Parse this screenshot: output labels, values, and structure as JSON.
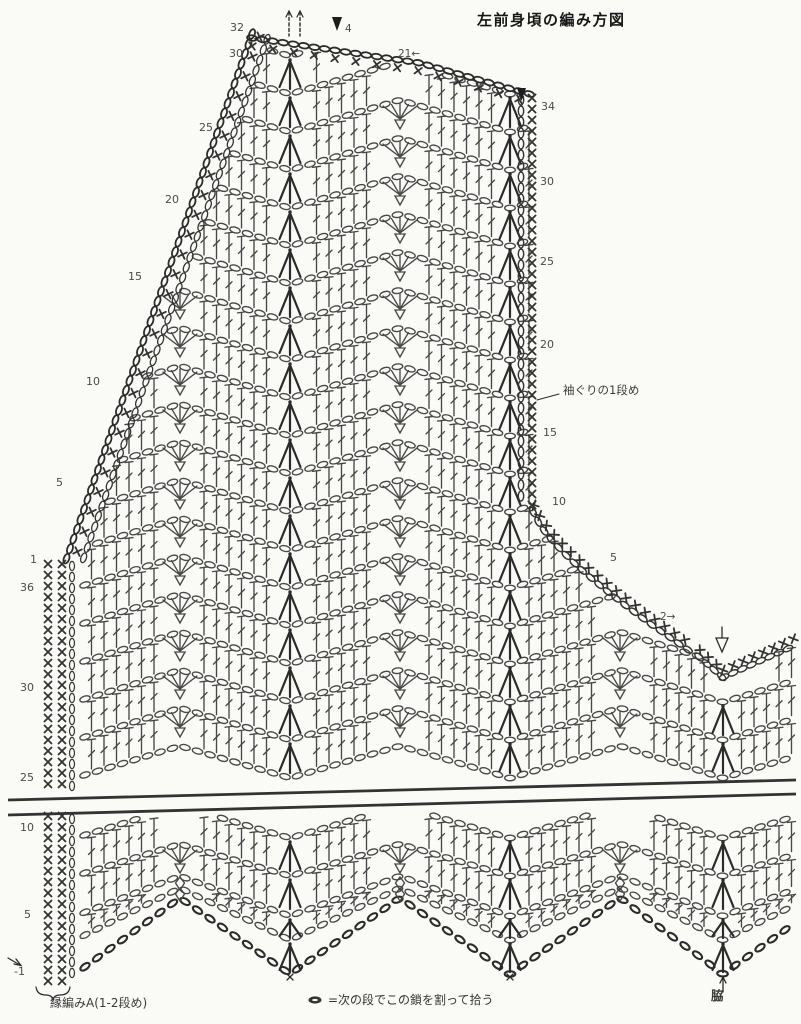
{
  "title": "左前身頃の編み方図",
  "colors": {
    "ink": "#474747",
    "ink_dark": "#2b2b2b",
    "edge": "#333333",
    "label": "#4a4a4a",
    "background": "#fafaf7"
  },
  "labels": {
    "armhole_row1": "袖ぐりの1段め",
    "edging_a": "縁編みA(1-2段め)",
    "side": "脇",
    "legend_text": "=次の段でこの鎖を割って拾う",
    "start_row_top": "4",
    "row_marker_21": "21←",
    "row_marker_2": "2→"
  },
  "stitch_symbols": [
    "chain-oval",
    "single-crochet-x",
    "double-crochet-bar",
    "cluster-3dc-decrease",
    "shell-5dc-increase",
    "picot-triangle",
    "start-arrow-filled",
    "start-arrow-open"
  ],
  "row_numbers": {
    "neck_edge": [
      {
        "v": "32",
        "x": 230,
        "y": 22
      },
      {
        "v": "30",
        "x": 229,
        "y": 48
      },
      {
        "v": "25",
        "x": 199,
        "y": 122
      },
      {
        "v": "20",
        "x": 165,
        "y": 194
      },
      {
        "v": "15",
        "x": 128,
        "y": 271
      },
      {
        "v": "10",
        "x": 86,
        "y": 376
      },
      {
        "v": "5",
        "x": 56,
        "y": 477
      },
      {
        "v": "1",
        "x": 30,
        "y": 554
      }
    ],
    "left_edge": [
      {
        "v": "36",
        "x": 20,
        "y": 582
      },
      {
        "v": "30",
        "x": 20,
        "y": 682
      },
      {
        "v": "25",
        "x": 20,
        "y": 772
      },
      {
        "v": "10",
        "x": 20,
        "y": 822
      },
      {
        "v": "5",
        "x": 24,
        "y": 909
      },
      {
        "v": "-1",
        "x": 14,
        "y": 966
      }
    ],
    "right_edge": [
      {
        "v": "34",
        "x": 541,
        "y": 101
      },
      {
        "v": "30",
        "x": 540,
        "y": 176
      },
      {
        "v": "25",
        "x": 540,
        "y": 256
      },
      {
        "v": "20",
        "x": 540,
        "y": 339
      },
      {
        "v": "15",
        "x": 543,
        "y": 427
      },
      {
        "v": "10",
        "x": 552,
        "y": 496
      },
      {
        "v": "5",
        "x": 610,
        "y": 552
      }
    ]
  }
}
